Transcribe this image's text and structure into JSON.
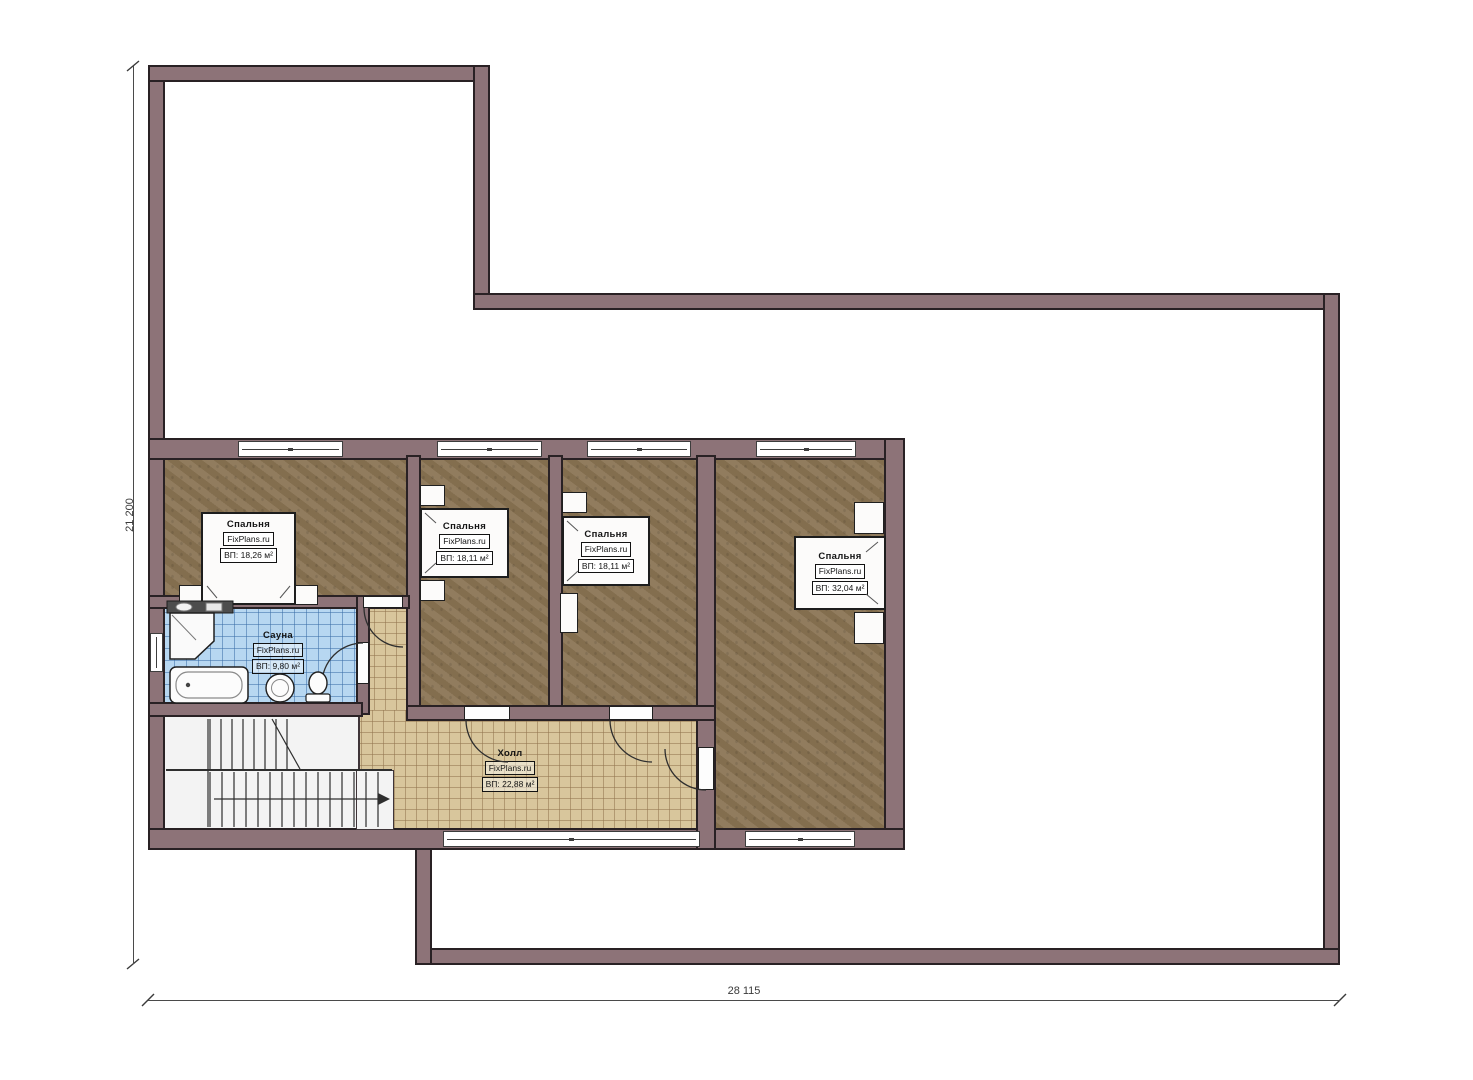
{
  "plan": {
    "watermark": "FixPlans.ru",
    "rooms": [
      {
        "name": "Спальня",
        "area": "ВП: 18,26 м²"
      },
      {
        "name": "Спальня",
        "area": "ВП: 18,11 м²"
      },
      {
        "name": "Спальня",
        "area": "ВП: 18,11 м²"
      },
      {
        "name": "Спальня",
        "area": "ВП: 32,04 м²"
      },
      {
        "name": "Сауна",
        "area": "ВП: 9,80 м²"
      },
      {
        "name": "Холл",
        "area": "ВП: 22,88 м²"
      }
    ],
    "dimensions": {
      "total_height_mm": "21 200",
      "total_width_mm": "28 115"
    },
    "colors": {
      "wall": "#8d7378",
      "carpet": "#8b7555",
      "hall_tile": "#d8c69c",
      "sauna_tile": "#b7d7f1",
      "stairs": "#f3f3f3"
    }
  }
}
